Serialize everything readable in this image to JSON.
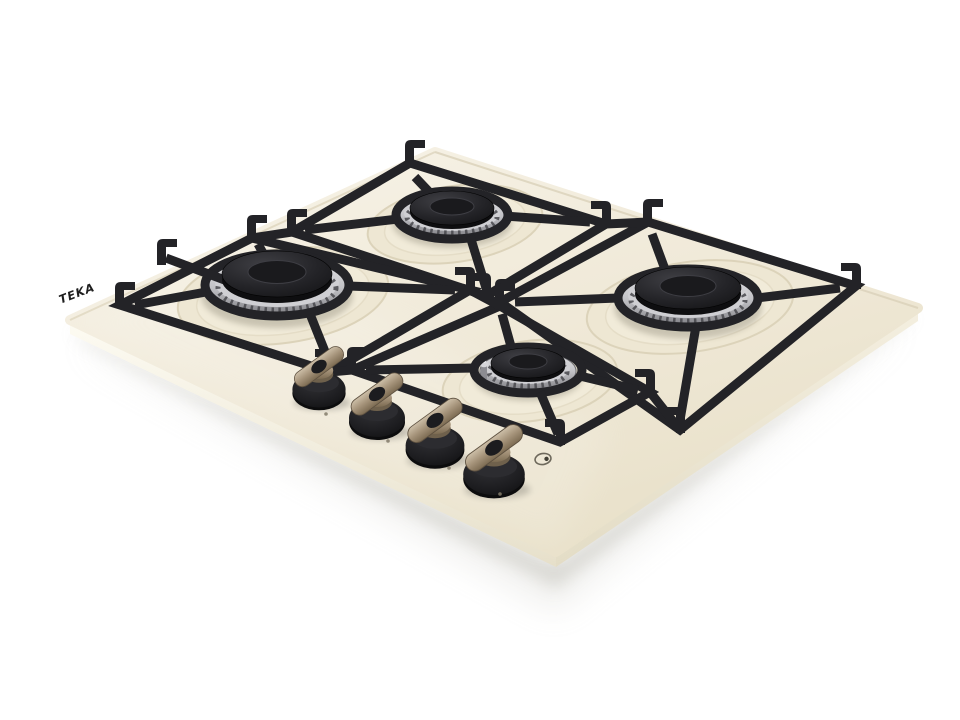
{
  "scene": {
    "background": "#ffffff",
    "subject": "gas hob product photo"
  },
  "brand": {
    "logo_text": "TEKA"
  },
  "hob": {
    "surface_color": "#efe8d6",
    "edge_highlight_color": "#fdfbf2",
    "pan_support_color": "#232327",
    "burner_steel_color": "#c2c2c6",
    "burner_cap_color": "#232326",
    "knob_body_color": "#1a1a1c",
    "knob_metal_color": "#a5937a",
    "burner_count": 4,
    "knob_count": 4,
    "burners": [
      {
        "id": "left",
        "size": "large"
      },
      {
        "id": "back-center",
        "size": "medium"
      },
      {
        "id": "right",
        "size": "large"
      },
      {
        "id": "front-center",
        "size": "small"
      }
    ],
    "knobs": [
      {
        "id": "knob-1"
      },
      {
        "id": "knob-2"
      },
      {
        "id": "knob-3"
      },
      {
        "id": "knob-4"
      }
    ],
    "printed_marks": {
      "ignition_symbol": "circle-with-spark-dot"
    }
  }
}
